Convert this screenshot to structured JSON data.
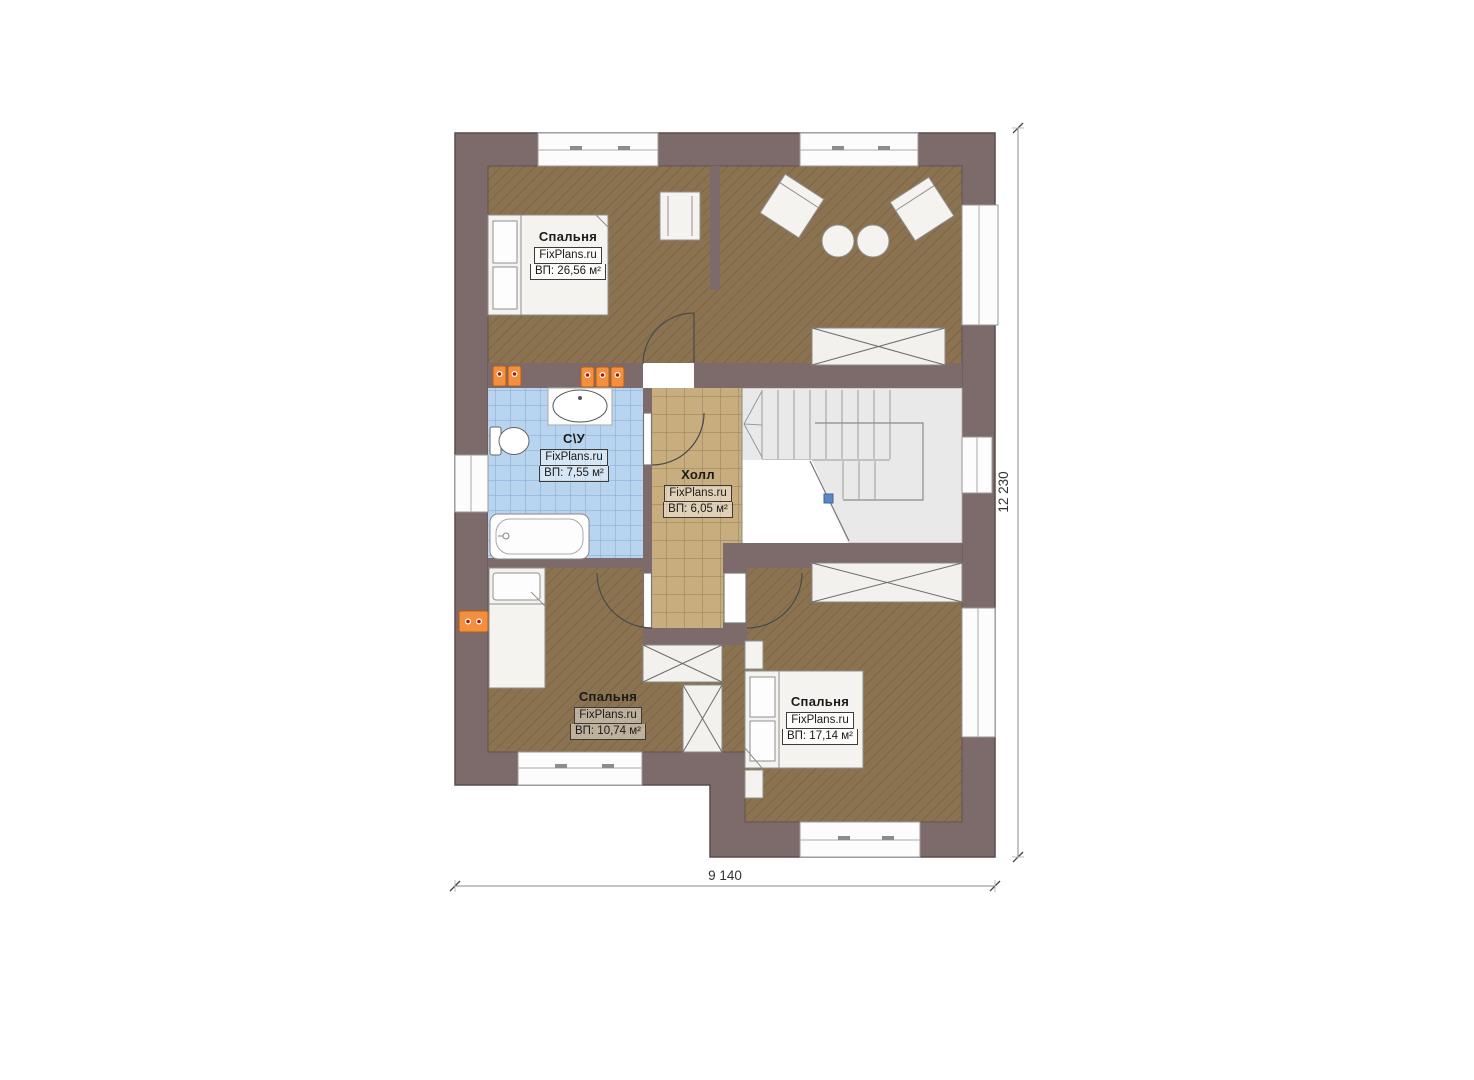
{
  "plan": {
    "brand": "FixPlans.ru",
    "floor_type": "second-floor-plan",
    "rooms": [
      {
        "name": "Спальня",
        "brand": "FixPlans.ru",
        "area": "ВП: 26,56 м²"
      },
      {
        "name": "С\\У",
        "brand": "FixPlans.ru",
        "area": "ВП: 7,55 м²"
      },
      {
        "name": "Холл",
        "brand": "FixPlans.ru",
        "area": "ВП: 6,05 м²"
      },
      {
        "name": "Спальня",
        "brand": "FixPlans.ru",
        "area": "ВП: 10,74 м²"
      },
      {
        "name": "Спальня",
        "brand": "FixPlans.ru",
        "area": "ВП: 17,14 м²"
      }
    ],
    "dimensions": {
      "width": "9 140",
      "height": "12 230"
    },
    "colors": {
      "wall": "#7d6b6b",
      "floor_wood": "#8b7351",
      "tile_bath": "#b9d4ef",
      "tile_hall": "#c8ad7f",
      "stairs": "#e9e9e9",
      "radiator": "#f08030",
      "stair_dot": "#5b87c5"
    }
  }
}
